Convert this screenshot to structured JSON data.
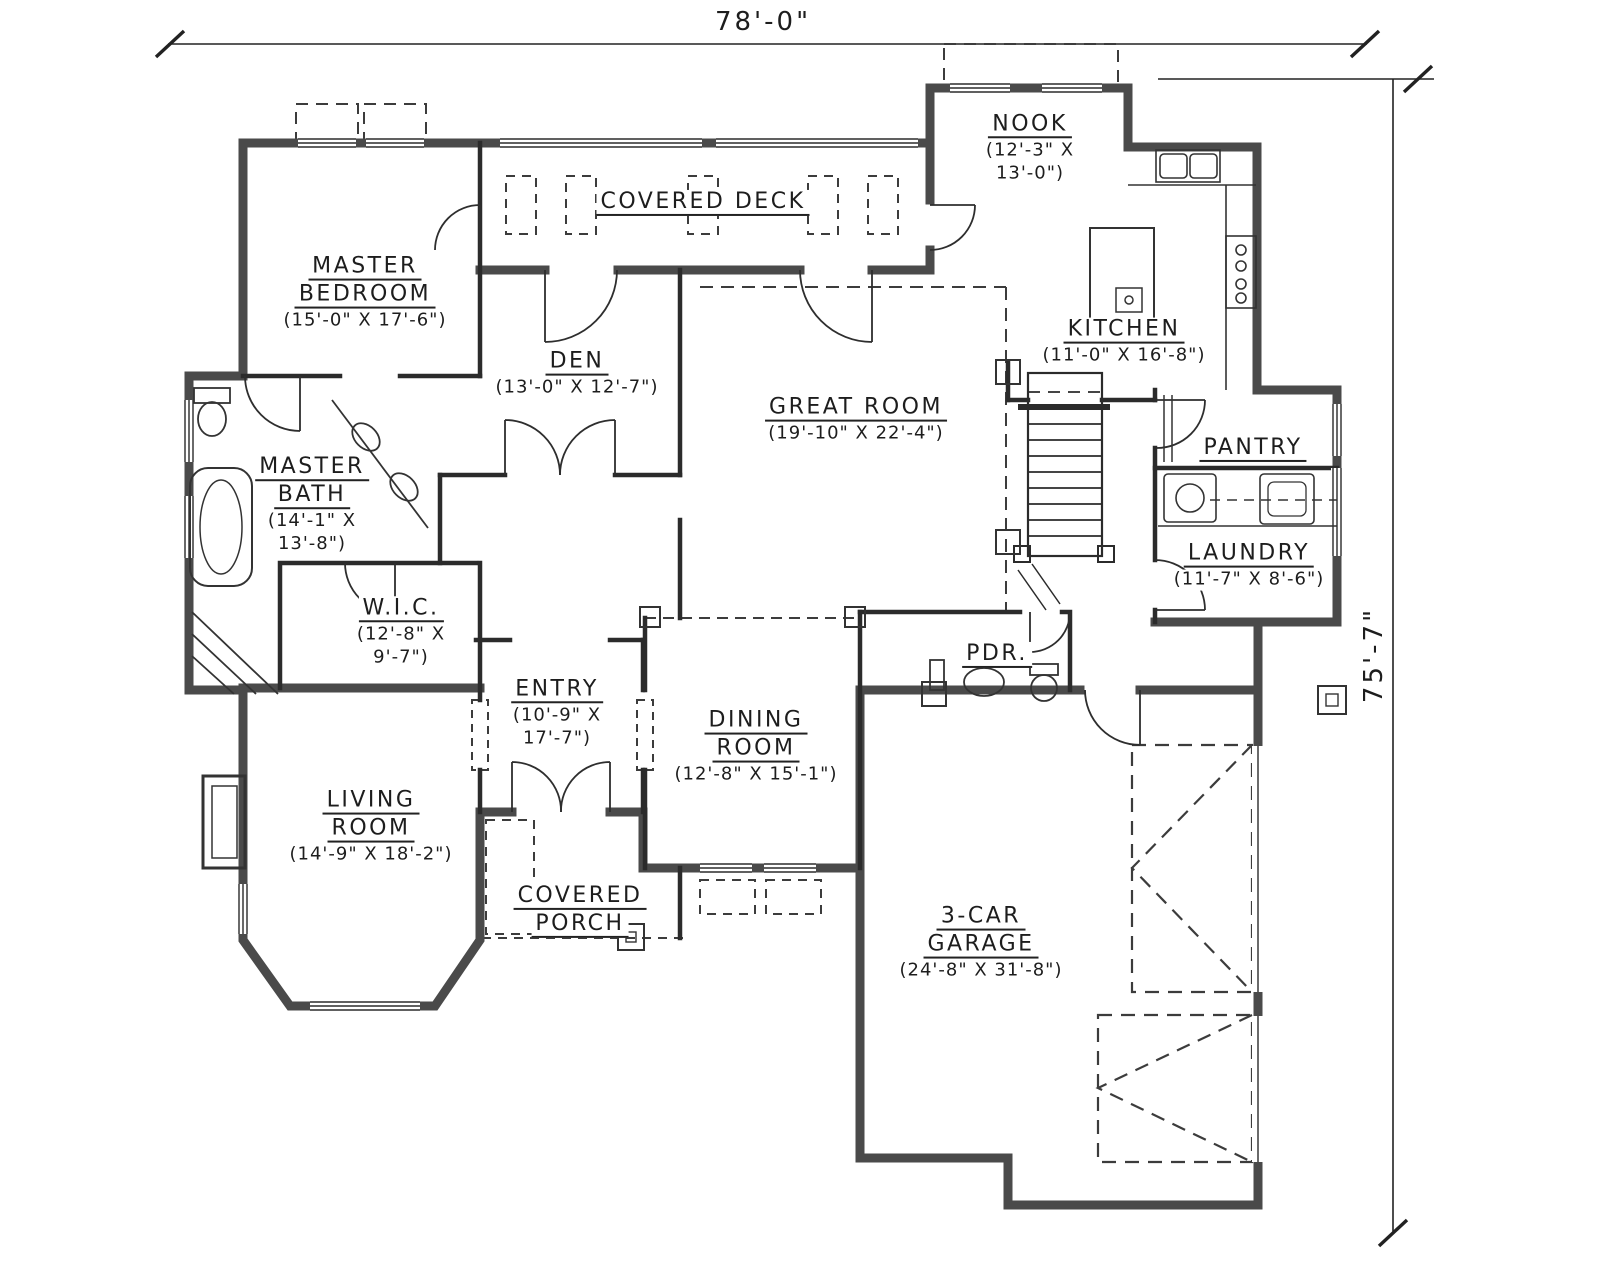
{
  "drawing": {
    "overall_width_dim": "78'-0\"",
    "overall_height_dim": "75'-7\""
  },
  "rooms": [
    {
      "id": "master-bedroom",
      "name_lines": [
        "MASTER",
        "BEDROOM"
      ],
      "size_lines": [
        "(15'-0\" X 17'-6\")"
      ]
    },
    {
      "id": "covered-deck",
      "name_lines": [
        "COVERED DECK"
      ],
      "size_lines": []
    },
    {
      "id": "nook",
      "name_lines": [
        "NOOK"
      ],
      "size_lines": [
        "(12'-3\" X",
        "13'-0\")"
      ]
    },
    {
      "id": "kitchen",
      "name_lines": [
        "KITCHEN"
      ],
      "size_lines": [
        "(11'-0\" X 16'-8\")"
      ]
    },
    {
      "id": "den",
      "name_lines": [
        "DEN"
      ],
      "size_lines": [
        "(13'-0\" X 12'-7\")"
      ]
    },
    {
      "id": "great-room",
      "name_lines": [
        "GREAT ROOM"
      ],
      "size_lines": [
        "(19'-10\" X 22'-4\")"
      ]
    },
    {
      "id": "master-bath",
      "name_lines": [
        "MASTER",
        "BATH"
      ],
      "size_lines": [
        "(14'-1\" X",
        "13'-8\")"
      ]
    },
    {
      "id": "pantry",
      "name_lines": [
        "PANTRY"
      ],
      "size_lines": []
    },
    {
      "id": "laundry",
      "name_lines": [
        "LAUNDRY"
      ],
      "size_lines": [
        "(11'-7\" X 8'-6\")"
      ]
    },
    {
      "id": "walk-in-closet",
      "name_lines": [
        "W.I.C."
      ],
      "size_lines": [
        "(12'-8\" X",
        "9'-7\")"
      ]
    },
    {
      "id": "entry",
      "name_lines": [
        "ENTRY"
      ],
      "size_lines": [
        "(10'-9\" X",
        "17'-7\")"
      ]
    },
    {
      "id": "dining-room",
      "name_lines": [
        "DINING",
        "ROOM"
      ],
      "size_lines": [
        "(12'-8\" X 15'-1\")"
      ]
    },
    {
      "id": "powder-room",
      "name_lines": [
        "PDR."
      ],
      "size_lines": []
    },
    {
      "id": "living-room",
      "name_lines": [
        "LIVING",
        "ROOM"
      ],
      "size_lines": [
        "(14'-9\" X 18'-2\")"
      ]
    },
    {
      "id": "covered-porch",
      "name_lines": [
        "COVERED",
        "PORCH"
      ],
      "size_lines": []
    },
    {
      "id": "three-car-garage",
      "name_lines": [
        "3-CAR",
        "GARAGE"
      ],
      "size_lines": [
        "(24'-8\" X 31'-8\")"
      ]
    }
  ]
}
